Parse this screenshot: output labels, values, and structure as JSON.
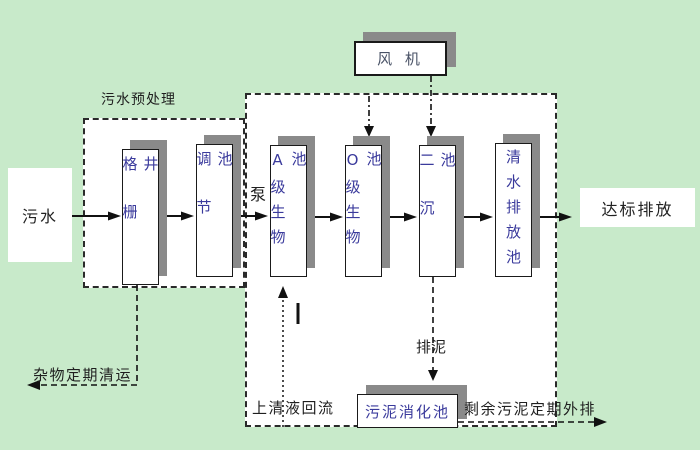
{
  "diagram_title": "污水处理工艺流程图",
  "colors": {
    "background": "#c8eaca",
    "section_fill": "#ffffff",
    "node_fill": "#ffffff",
    "node_border": "#1a1a1a",
    "node_shadow": "#8a8a8a",
    "tank_text": "#3a3a9c",
    "fan_text": "#495266",
    "annotation_text": "#1f1f1f"
  },
  "nodes": {
    "fan": {
      "label": "风 机"
    },
    "sewage": {
      "label": "污水"
    },
    "grid_well": {
      "label": "格栅井"
    },
    "regulating_tank": {
      "label": "调节池"
    },
    "a_bio_tank": {
      "label": "A级生物池"
    },
    "o_bio_tank": {
      "label": "O级生物池"
    },
    "secondary_sedimentation_tank": {
      "label": "二沉池"
    },
    "clear_water_discharge_tank": {
      "label": "清水排放池"
    },
    "sludge_digestion_tank": {
      "label": "污泥消化池"
    },
    "standard_discharge": {
      "label": "达标排放"
    }
  },
  "annotations": {
    "pretreatment_section": "污水预处理",
    "pump": "泵",
    "debris_removal": "杂物定期清运",
    "supernatant_return": "上清液回流",
    "sludge_discharge": "排泥",
    "excess_sludge_discharge": "剩余污泥定期外排"
  }
}
